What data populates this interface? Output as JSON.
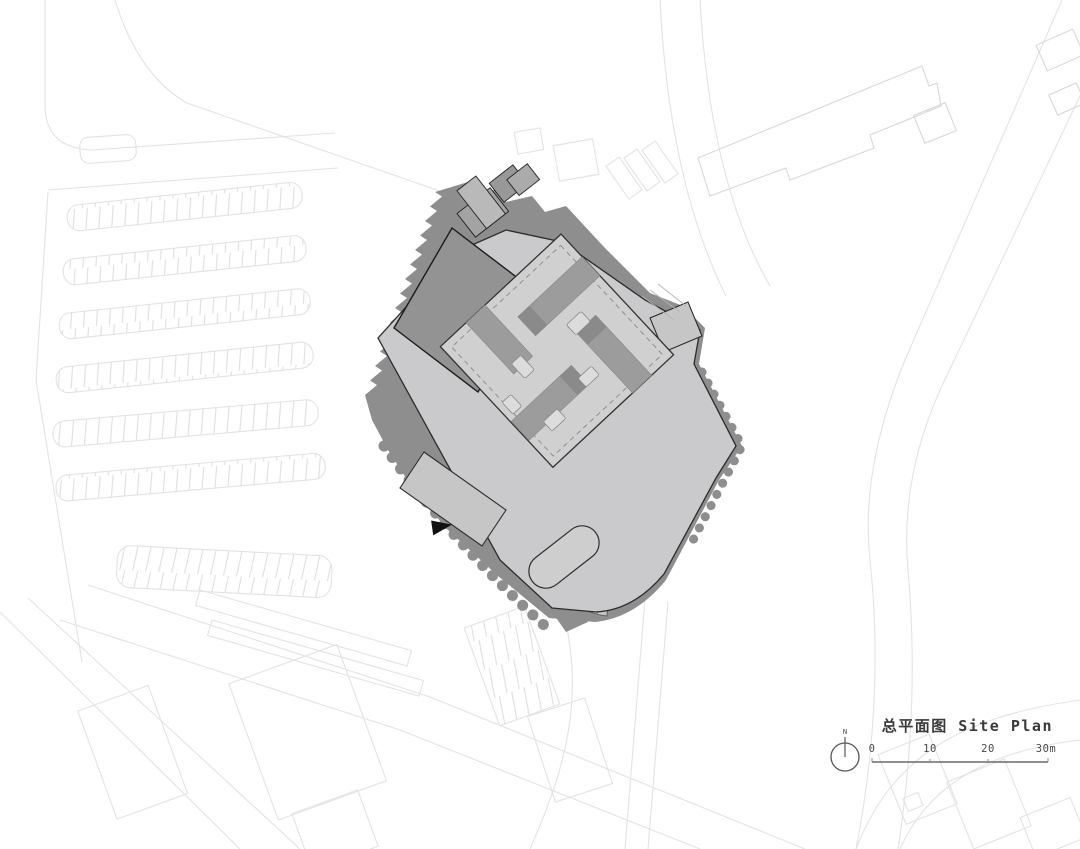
{
  "drawing": {
    "type": "architectural site plan",
    "title": "总平面图 Site Plan",
    "title_zh": "总平面图",
    "title_en": "Site Plan"
  },
  "north_arrow": {
    "label": "N"
  },
  "scale_bar": {
    "ticks": [
      "0",
      "10",
      "20",
      "30m"
    ],
    "unit": "m",
    "length_m": 30
  },
  "colors": {
    "background": "#ffffff",
    "context_line": "#e3e3e6",
    "context_line_dark": "#d8d8db",
    "shadow": "#8e8e8e",
    "building_light": "#cacacc",
    "building_mid": "#9c9c9c",
    "roof_light": "#d0d0d0",
    "slab_roof": "#939393",
    "outline": "#2b2b2b",
    "text": "#3a3a3a"
  }
}
